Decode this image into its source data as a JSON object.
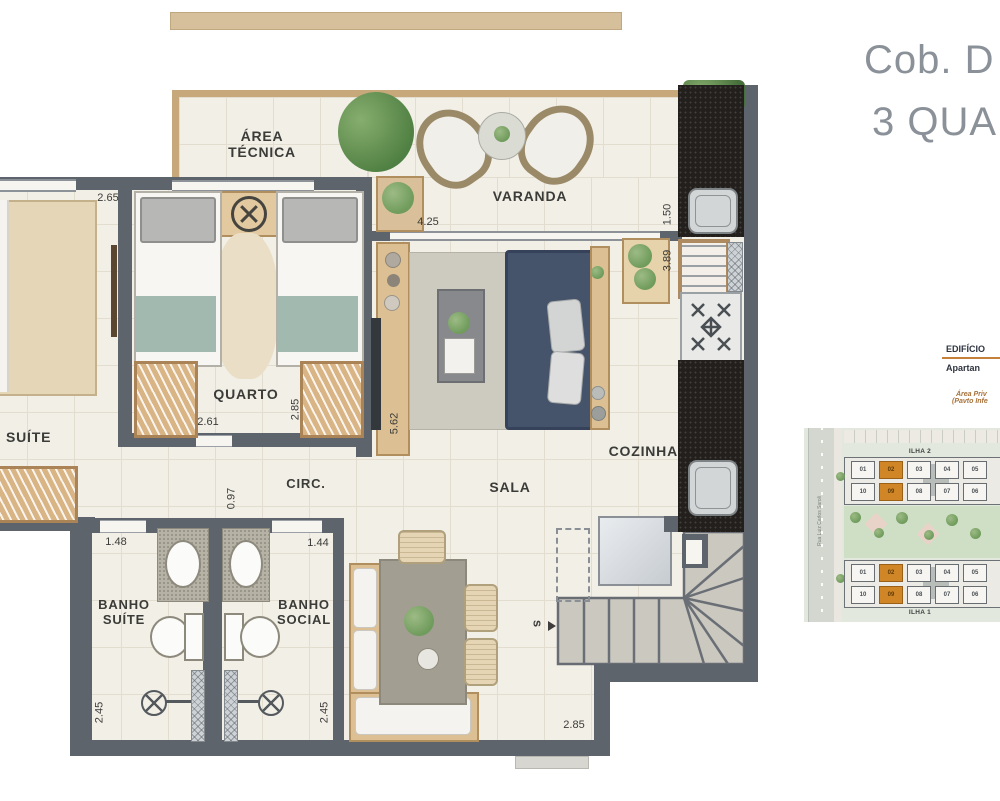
{
  "page": {
    "title_line1": "Cob. D",
    "title_line2": "3 QUA"
  },
  "info_panel": {
    "heading": "EDIFÍCIO",
    "subheading": "Apartan",
    "note_line1": "Área Priv",
    "note_line2": "(Pavto Infe"
  },
  "floor_plan": {
    "rooms": {
      "area_tecnica_line1": "ÁREA",
      "area_tecnica_line2": "TÉCNICA",
      "varanda": "VARANDA",
      "suite": "SUÍTE",
      "quarto": "QUARTO",
      "circ": "CIRC.",
      "sala": "SALA",
      "cozinha": "COZINHA",
      "banho_suite_line1": "BANHO",
      "banho_suite_line2": "SUÍTE",
      "banho_social_line1": "BANHO",
      "banho_social_line2": "SOCIAL"
    },
    "dimensions": {
      "suite_width": "2.65",
      "quarto_width": "2.61",
      "quarto_depth": "2.85",
      "circ_width": "0.97",
      "sala_depth": "5.62",
      "varanda_width": "4.25",
      "cozinha_width": "1.50",
      "cozinha_depth": "3.89",
      "banho_suite_width": "1.48",
      "banho_social_width": "1.44",
      "banho_suite_depth": "2.45",
      "banho_social_depth": "2.45",
      "stairs_width": "2.85"
    },
    "stairs_marker": "s"
  },
  "site_map": {
    "street_name": "Rua Luiz Carlos Saroli",
    "highlight_color": "#d08627",
    "blocks": [
      {
        "label": "ILHA 2",
        "rows": [
          [
            "01",
            "02",
            "03",
            "04",
            "05"
          ],
          [
            "10",
            "09",
            "08",
            "07",
            "06"
          ]
        ],
        "highlighted": [
          "02",
          "09"
        ]
      },
      {
        "label": "ILHA 1",
        "rows": [
          [
            "01",
            "02",
            "03",
            "04",
            "05"
          ],
          [
            "10",
            "09",
            "08",
            "07",
            "06"
          ]
        ],
        "highlighted": [
          "02",
          "09"
        ]
      }
    ]
  },
  "colors": {
    "wall": "#5d646c",
    "floor": "#f2efe7",
    "wood_trim": "#c7a87b",
    "title_gray": "#8b9198",
    "accent_orange": "#c5803a",
    "unit_highlight": "#d08627"
  }
}
